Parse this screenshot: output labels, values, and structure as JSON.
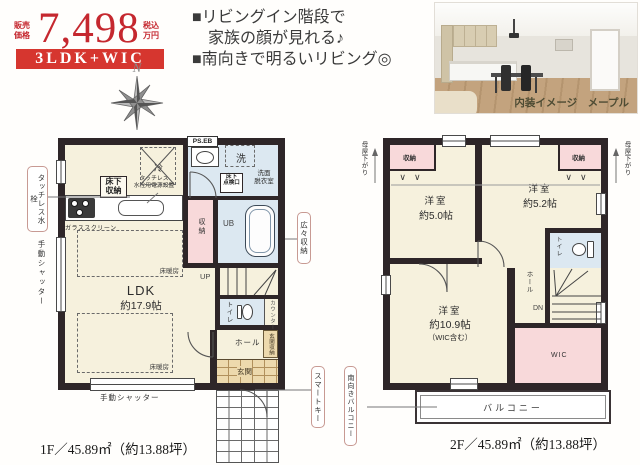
{
  "header": {
    "price_label": "販売\n価格",
    "price_value": "7,498",
    "price_unit": "税込\n万円",
    "layout_badge": "3LDK+WIC",
    "bullets": [
      "■リビングイン階段で",
      "　家族の顔が見れる♪",
      "■南向きで明るいリビング◎"
    ],
    "compass_n": "N",
    "photo_caption": "内装イメージ　メープル"
  },
  "floor1": {
    "area_label": "1F／45.89㎡（約13.88坪）",
    "ldk_name": "LDK",
    "ldk_size": "約17.9帖",
    "floor_heating_1": "床暖房",
    "floor_heating_2": "床暖房",
    "underfloor_storage": "床下\n収納",
    "touchless_note": "タッチレス\n水栓用電源設置",
    "glass_screen": "ガラススクリーン",
    "fridge": "冷",
    "pipe_space": "PS.EB",
    "washer": "洗",
    "washroom": "洗面\n脱衣室",
    "inspection_hatch": "床下\n点検口",
    "storage": "収納",
    "unit_bath": "UB",
    "stairs_up": "UP",
    "toilet": "トイレ",
    "counter": "カウンター",
    "hall": "ホール",
    "entrance_storage": "玄関収納",
    "entrance": "玄関",
    "shutter_left": "手動シャッター",
    "shutter_bottom": "手動シャッター",
    "callout_touchless_faucet": "タッチレス水栓",
    "callout_roomy_storage": "広々収納",
    "callout_smart_key": "スマートキー"
  },
  "floor2": {
    "area_label": "2F／45.89㎡（約13.88坪）",
    "room1_name": "洋室",
    "room1_size": "約5.0帖",
    "room2_name": "洋室",
    "room2_size": "約5.2帖",
    "room3_name": "洋室",
    "room3_size": "約10.9帖",
    "room3_note": "（WIC含む）",
    "storage_left": "収納",
    "storage_right": "収納",
    "sloped_ceiling_left": "母屋下がり",
    "sloped_ceiling_right": "母屋下がり",
    "toilet": "トイレ",
    "hall": "ホール",
    "stairs_down": "DN",
    "wic": "WIC",
    "balcony": "バルコニー",
    "callout_south_balcony": "南向きバルコニー"
  },
  "colors": {
    "accent_red": "#c5282f",
    "banner_red": "#d6362f",
    "wall_dark": "#2e2628",
    "room_cream": "#f6f1dd",
    "room_pink": "#f8d9da",
    "room_blue": "#dce8f1",
    "entrance_tan": "#edd9ad"
  }
}
